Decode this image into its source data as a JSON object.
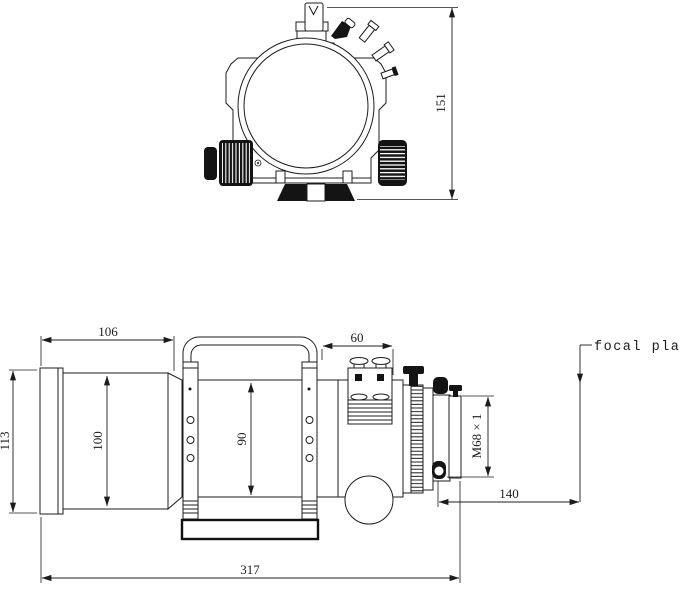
{
  "page": {
    "background_color": "#ffffff",
    "line_color": "#1c1c1c",
    "description_labels": {
      "focal_plane": "focal plane"
    }
  },
  "front_view": {
    "overall_height_dim": "151"
  },
  "side_view": {
    "dew_shield_length_dim": "106",
    "ring_span_dim": "60",
    "dew_shield_od_dim": "113",
    "dew_shield_inner_dim": "100",
    "tube_od_dim": "90",
    "overall_length_dim": "317",
    "back_focus_dim": "140",
    "rear_thread_label": "M68 × 1"
  }
}
